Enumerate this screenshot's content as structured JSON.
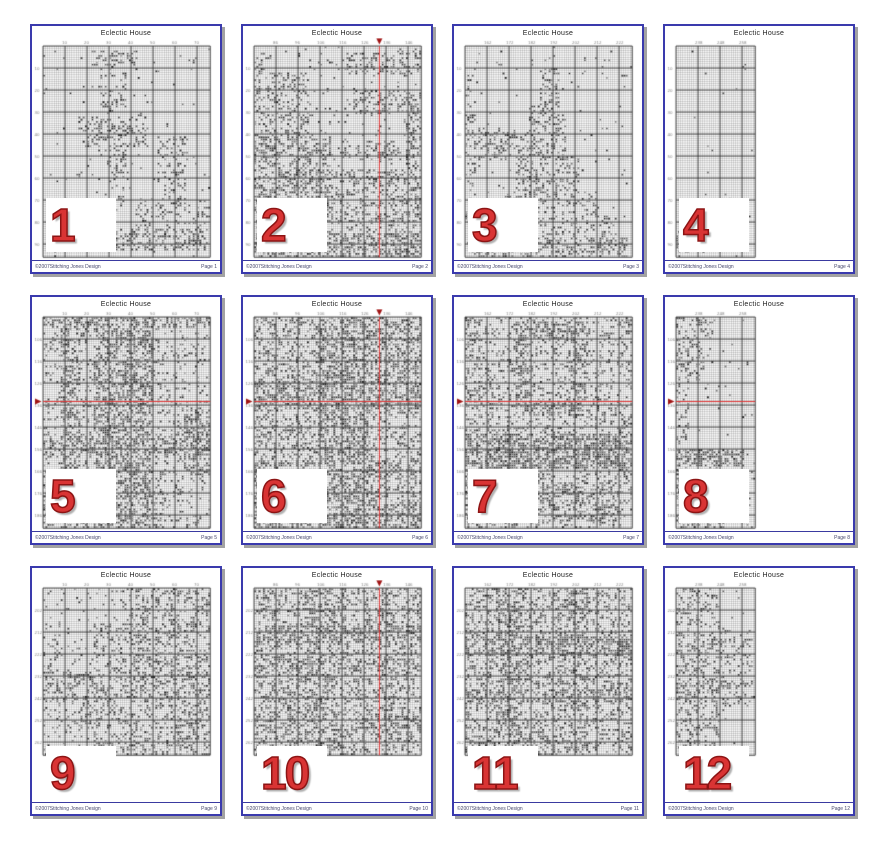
{
  "document": {
    "title": "Eclectic House",
    "copyright": "©2007Stitching Jones Design"
  },
  "colors": {
    "page_border": "#3a3aad",
    "page_shadow": "#a2a2a2",
    "number_red": "#d93434",
    "number_outline": "#8c1414",
    "center_line_red": "#e03434",
    "center_arrow_red": "#a01414",
    "grid_minor": "rgba(0,0,0,0.33)",
    "grid_major": "rgba(35,35,35,0.8)",
    "tick_label": "#888888",
    "footer_rule": "#3a3aa0",
    "stitch_dark": "#222222"
  },
  "grid": {
    "cols_full": 76,
    "cols_narrow": 36,
    "rows_tall": 96,
    "rows_short": 76,
    "major_every": 10
  },
  "pages": [
    {
      "number": "1",
      "label": "Page 1",
      "red_h": null,
      "red_v": null,
      "base_density": 0.02,
      "regions": [
        [
          0.28,
          0.02,
          0.28,
          0.07,
          0.3
        ],
        [
          0.33,
          0.09,
          0.14,
          0.28,
          0.22
        ],
        [
          0.2,
          0.33,
          0.42,
          0.14,
          0.32
        ],
        [
          0.36,
          0.47,
          0.12,
          0.3,
          0.18
        ],
        [
          0.68,
          0.42,
          0.18,
          0.33,
          0.22
        ],
        [
          0.55,
          0.72,
          0.45,
          0.14,
          0.22
        ],
        [
          0.02,
          0.86,
          0.96,
          0.1,
          0.38
        ],
        [
          0.45,
          0.1,
          0.04,
          0.5,
          0.3
        ]
      ]
    },
    {
      "number": "2",
      "label": "Page 2",
      "red_h": null,
      "red_v": 0.75,
      "base_density": 0.05,
      "regions": [
        [
          0.0,
          0.03,
          0.1,
          0.95,
          0.3
        ],
        [
          0.06,
          0.12,
          0.26,
          0.55,
          0.3
        ],
        [
          0.0,
          0.42,
          0.45,
          0.3,
          0.45
        ],
        [
          0.18,
          0.44,
          0.78,
          0.1,
          0.28
        ],
        [
          0.55,
          0.03,
          0.45,
          0.1,
          0.32
        ],
        [
          0.58,
          0.2,
          0.42,
          0.12,
          0.35
        ],
        [
          0.3,
          0.58,
          0.68,
          0.4,
          0.3
        ],
        [
          0.0,
          0.88,
          1.0,
          0.12,
          0.5
        ],
        [
          0.9,
          0.3,
          0.1,
          0.6,
          0.38
        ]
      ]
    },
    {
      "number": "3",
      "label": "Page 3",
      "red_h": null,
      "red_v": null,
      "base_density": 0.025,
      "regions": [
        [
          0.44,
          0.1,
          0.12,
          0.3,
          0.35
        ],
        [
          0.38,
          0.28,
          0.22,
          0.25,
          0.32
        ],
        [
          0.0,
          0.4,
          0.45,
          0.14,
          0.35
        ],
        [
          0.3,
          0.52,
          0.38,
          0.18,
          0.3
        ],
        [
          0.2,
          0.68,
          0.58,
          0.16,
          0.25
        ],
        [
          0.08,
          0.8,
          0.82,
          0.12,
          0.22
        ],
        [
          0.03,
          0.9,
          0.94,
          0.1,
          0.38
        ],
        [
          0.0,
          0.12,
          0.06,
          0.75,
          0.18
        ]
      ]
    },
    {
      "number": "4",
      "label": "Page 4",
      "red_h": null,
      "red_v": null,
      "base_density": 0.004,
      "regions": [
        [
          0.0,
          0.84,
          0.2,
          0.16,
          0.22
        ]
      ]
    },
    {
      "number": "5",
      "label": "Page 5",
      "red_h": 0.4,
      "red_v": null,
      "base_density": 0.15,
      "regions": [
        [
          0.1,
          0.0,
          0.12,
          1.0,
          0.45
        ],
        [
          0.3,
          0.0,
          0.34,
          1.0,
          0.5
        ],
        [
          0.0,
          0.0,
          1.0,
          0.05,
          0.5
        ],
        [
          0.84,
          0.42,
          0.16,
          0.33,
          0.5
        ],
        [
          0.0,
          0.55,
          1.0,
          0.1,
          0.45
        ],
        [
          0.0,
          0.72,
          0.72,
          0.28,
          0.33
        ],
        [
          0.55,
          0.0,
          0.1,
          0.6,
          0.45
        ]
      ]
    },
    {
      "number": "6",
      "label": "Page 6",
      "red_h": 0.4,
      "red_v": 0.75,
      "base_density": 0.3,
      "regions": [
        [
          0.38,
          0.0,
          0.3,
          1.0,
          0.5
        ],
        [
          0.0,
          0.3,
          1.0,
          0.13,
          0.55
        ],
        [
          0.0,
          0.68,
          1.0,
          0.1,
          0.5
        ],
        [
          0.68,
          0.0,
          0.32,
          0.45,
          0.45
        ],
        [
          0.0,
          0.88,
          1.0,
          0.12,
          0.5
        ]
      ]
    },
    {
      "number": "7",
      "label": "Page 7",
      "red_h": 0.4,
      "red_v": null,
      "base_density": 0.22,
      "regions": [
        [
          0.3,
          0.02,
          0.42,
          0.08,
          0.5
        ],
        [
          0.3,
          0.1,
          0.08,
          0.32,
          0.5
        ],
        [
          0.64,
          0.1,
          0.08,
          0.32,
          0.5
        ],
        [
          0.34,
          0.38,
          0.36,
          0.08,
          0.55
        ],
        [
          0.0,
          0.55,
          1.0,
          0.16,
          0.65
        ],
        [
          0.08,
          0.78,
          0.85,
          0.18,
          0.45
        ],
        [
          0.0,
          0.0,
          0.08,
          1.0,
          0.35
        ]
      ]
    },
    {
      "number": "8",
      "label": "Page 8",
      "red_h": 0.4,
      "red_v": null,
      "base_density": 0.02,
      "regions": [
        [
          0.0,
          0.0,
          0.5,
          0.1,
          0.25
        ],
        [
          0.0,
          0.08,
          0.35,
          0.22,
          0.3
        ],
        [
          0.0,
          0.3,
          0.15,
          0.3,
          0.2
        ],
        [
          0.0,
          0.62,
          0.85,
          0.08,
          0.55
        ],
        [
          0.0,
          0.7,
          0.55,
          0.1,
          0.4
        ],
        [
          0.0,
          0.8,
          0.3,
          0.2,
          0.35
        ],
        [
          0.1,
          0.92,
          0.5,
          0.08,
          0.3
        ]
      ]
    },
    {
      "number": "9",
      "label": "Page 9",
      "red_h": null,
      "red_v": null,
      "base_density": 0.08,
      "regions": [
        [
          0.5,
          0.0,
          0.5,
          0.55,
          0.35
        ],
        [
          0.3,
          0.2,
          0.3,
          0.4,
          0.25
        ],
        [
          0.0,
          0.5,
          1.0,
          0.18,
          0.35
        ],
        [
          0.15,
          0.68,
          0.85,
          0.15,
          0.3
        ],
        [
          0.0,
          0.3,
          0.2,
          0.4,
          0.12
        ],
        [
          0.3,
          0.85,
          0.7,
          0.15,
          0.3
        ]
      ]
    },
    {
      "number": "10",
      "label": "Page 10",
      "red_h": null,
      "red_v": 0.75,
      "base_density": 0.32,
      "regions": [
        [
          0.0,
          0.22,
          1.0,
          0.1,
          0.55
        ],
        [
          0.0,
          0.42,
          1.0,
          0.07,
          0.5
        ],
        [
          0.3,
          0.0,
          0.18,
          1.0,
          0.45
        ],
        [
          0.0,
          0.75,
          1.0,
          0.1,
          0.45
        ],
        [
          0.75,
          0.0,
          0.1,
          1.0,
          0.4
        ]
      ]
    },
    {
      "number": "11",
      "label": "Page 11",
      "red_h": null,
      "red_v": null,
      "base_density": 0.3,
      "regions": [
        [
          0.0,
          0.28,
          1.0,
          0.12,
          0.6
        ],
        [
          0.18,
          0.0,
          0.14,
          1.0,
          0.5
        ],
        [
          0.55,
          0.0,
          0.18,
          1.0,
          0.42
        ],
        [
          0.0,
          0.6,
          1.0,
          0.08,
          0.5
        ],
        [
          0.0,
          0.88,
          0.6,
          0.12,
          0.4
        ]
      ]
    },
    {
      "number": "12",
      "label": "Page 12",
      "red_h": null,
      "red_v": null,
      "base_density": 0.02,
      "regions": [
        [
          0.0,
          0.0,
          0.55,
          0.95,
          0.3
        ],
        [
          0.0,
          0.3,
          0.95,
          0.05,
          0.45
        ],
        [
          0.0,
          0.55,
          0.95,
          0.05,
          0.45
        ],
        [
          0.55,
          0.25,
          0.4,
          0.45,
          0.18
        ],
        [
          0.0,
          0.9,
          0.4,
          0.1,
          0.3
        ]
      ]
    }
  ]
}
